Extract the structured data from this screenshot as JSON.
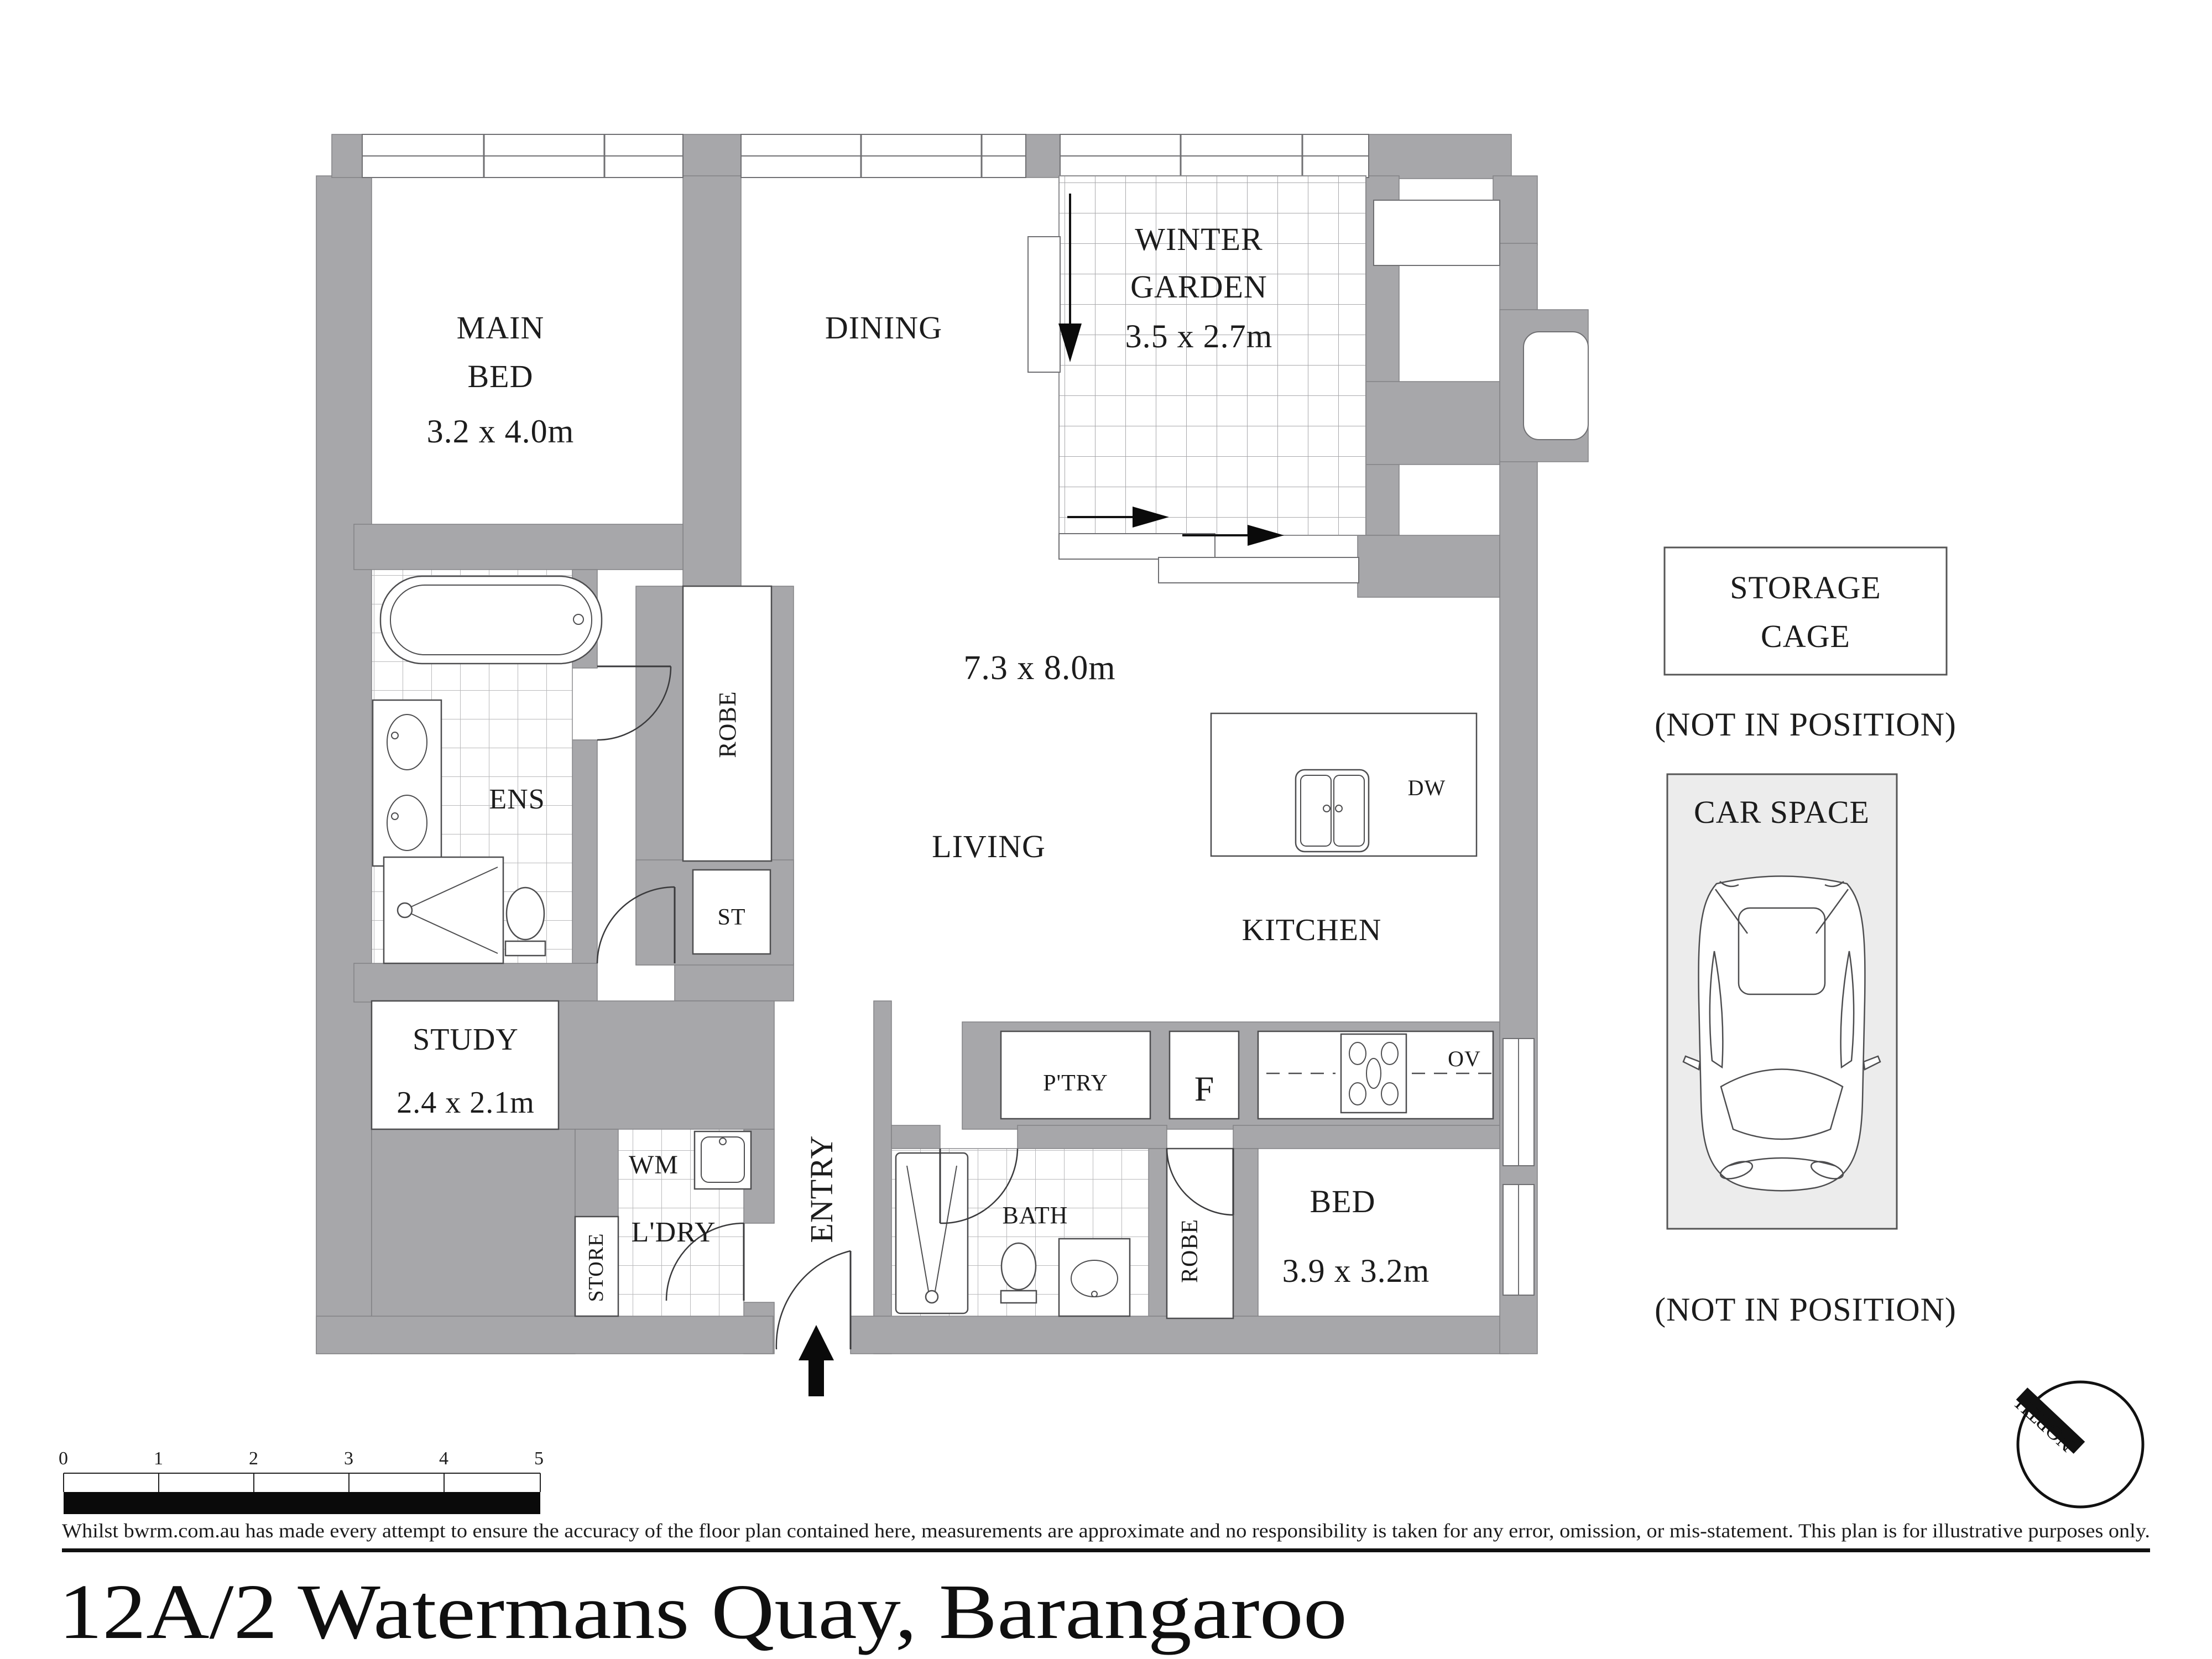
{
  "title": "12A/2 Watermans Quay, Barangaroo",
  "disclaimer": "Whilst bwrm.com.au has made every attempt to ensure the accuracy of the floor plan contained here, measurements are approximate and no responsibility is taken for any error, omission, or mis-statement. This plan is for illustrative purposes only.",
  "scale_bar": {
    "ticks": [
      "0",
      "1",
      "2",
      "3",
      "4",
      "5"
    ]
  },
  "compass": {
    "label": "NORTH"
  },
  "rooms": {
    "main_bed": {
      "line1": "MAIN",
      "line2": "BED",
      "dims": "3.2 x 4.0m"
    },
    "dining": {
      "label": "DINING"
    },
    "winter_garden": {
      "line1": "WINTER",
      "line2": "GARDEN",
      "dims": "3.5 x 2.7m"
    },
    "living": {
      "label": "LIVING",
      "dims": "7.3 x 8.0m"
    },
    "kitchen": {
      "label": "KITCHEN"
    },
    "ens": {
      "label": "ENS"
    },
    "robe_main": {
      "label": "ROBE"
    },
    "st": {
      "label": "ST"
    },
    "study": {
      "label": "STUDY",
      "dims": "2.4 x 2.1m"
    },
    "laundry": {
      "label": "L'DRY",
      "wm": "WM",
      "store": "STORE"
    },
    "entry": {
      "label": "ENTRY"
    },
    "bath": {
      "label": "BATH"
    },
    "robe_bed": {
      "label": "ROBE"
    },
    "bed": {
      "label": "BED",
      "dims": "3.9 x 3.2m"
    }
  },
  "kitchen_labels": {
    "dw": "DW",
    "pantry": "P'TRY",
    "fridge": "F",
    "oven": "OV"
  },
  "outside": {
    "storage_line1": "STORAGE",
    "storage_line2": "CAGE",
    "not_in_position": "(NOT IN POSITION)",
    "car_space": "CAR SPACE"
  },
  "colors": {
    "wall": "#a7a7aa",
    "text": "#1c1c1c",
    "tile_line": "#b9b9bb",
    "car_space_fill": "#ececec",
    "scale_bar": "#000000"
  }
}
